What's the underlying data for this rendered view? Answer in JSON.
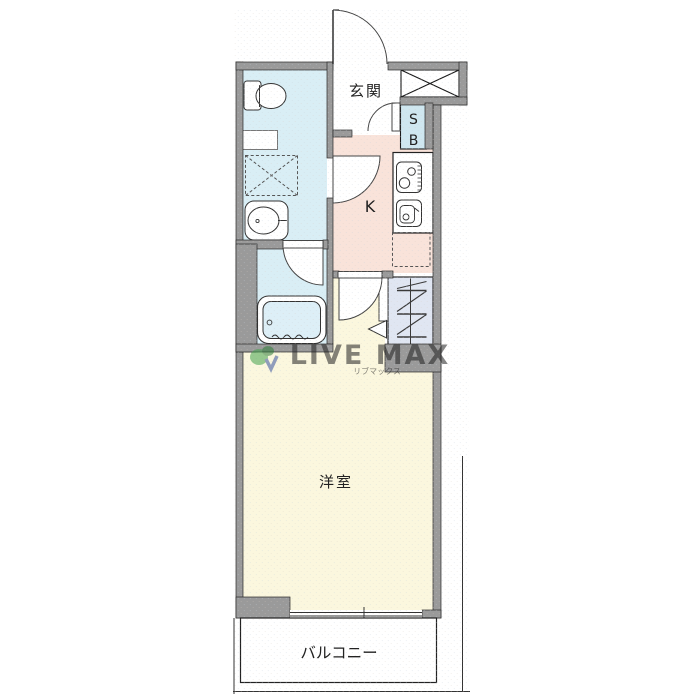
{
  "floorplan": {
    "rooms": {
      "genkan": {
        "label": "玄関"
      },
      "kitchen": {
        "label": "K"
      },
      "western_room": {
        "label": "洋室"
      },
      "balcony": {
        "label": "バルコニー"
      },
      "shoe_box": {
        "top": "S",
        "bottom": "B"
      }
    },
    "watermark": {
      "brand": "LIVE MAX",
      "brand_sub": "リブマックス"
    },
    "colors": {
      "wall": "#9a9a9a",
      "outline": "#2a2a2a",
      "wet_area_floor": "#d9eef5",
      "bathtub_water": "#ddeff7",
      "kitchen_floor": "#f9e3da",
      "room_floor": "#fbf7de",
      "closet_floor": "#e0e6f2",
      "shoe_box_fill": "#cfe7f0",
      "genkan_floor": "#ffffff",
      "balcony_floor": "#ffffff",
      "watermark_text": "#99a0c4",
      "watermark_sub": "#cb9a85",
      "logo_green": "#44a34e",
      "logo_blue": "#3b55a0"
    },
    "fixtures": {
      "toilet": "toilet-icon",
      "washing_machine_space": "washer-space-icon",
      "washbasin": "washbasin-icon",
      "bathtub": "bathtub-icon",
      "stove": "stove-icon",
      "kitchen_sink": "kitchen-sink-icon",
      "refrigerator_space": "fridge-space-icon",
      "pipe_shaft": "pipe-shaft-x-icon",
      "hanger_pipe": "hanger-pipe-icon",
      "entrance_door": "door-swing-icon",
      "window": "sliding-window-icon"
    }
  }
}
